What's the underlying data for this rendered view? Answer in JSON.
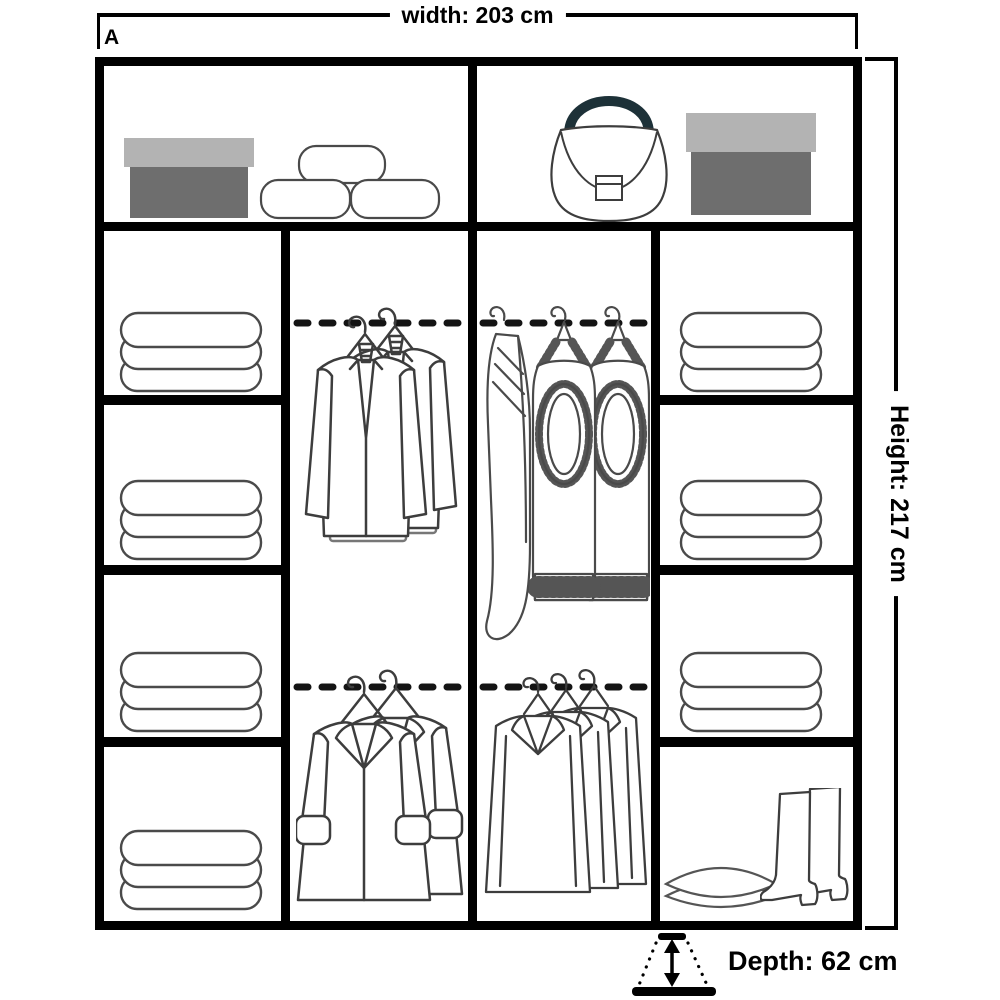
{
  "labels": {
    "variant": "A",
    "width": "width: 203 cm",
    "height": "Height: 217 cm",
    "depth": "Depth: 62 cm"
  },
  "colors": {
    "frame": "#000000",
    "line_art": "#3d3d3d",
    "box_lid": "#b3b3b3",
    "box_body": "#6e6e6e",
    "bag_handle": "#1d3138",
    "background": "#ffffff"
  },
  "wardrobe": {
    "top_shelf": {
      "left_compartment": [
        "storage-box",
        "rolled-towels-x3"
      ],
      "right_compartment": [
        "handbag",
        "storage-box"
      ]
    },
    "columns": [
      {
        "name": "left-shelves",
        "compartments": [
          "towel-stack",
          "towel-stack",
          "towel-stack",
          "towel-stack"
        ]
      },
      {
        "name": "hanging-left",
        "compartments": [
          "rail-with-2-suit-jackets",
          "rail-with-2-coats"
        ]
      },
      {
        "name": "hanging-right",
        "compartments": [
          "rail-with-cardigan-and-2-knit-garments",
          "rail-with-3-shirts"
        ]
      },
      {
        "name": "right-shelves",
        "compartments": [
          "towel-stack",
          "towel-stack",
          "towel-stack",
          "pillows-and-boots"
        ]
      }
    ]
  }
}
